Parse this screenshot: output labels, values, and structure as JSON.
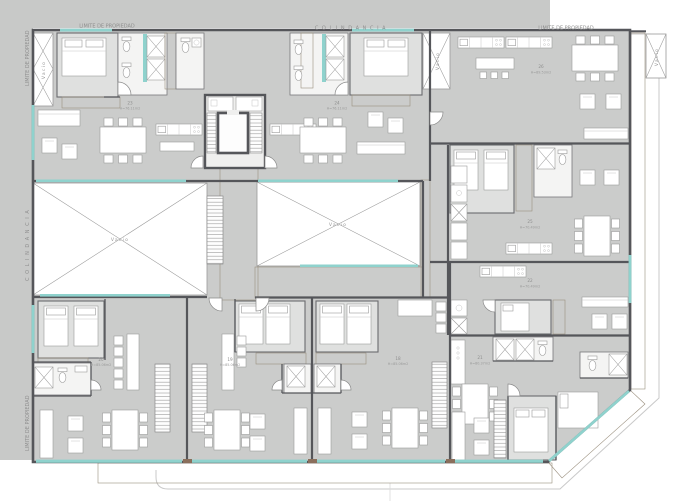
{
  "drawing": {
    "boundary": {
      "limite_top_left": "LIMITE  DE  PROPIEDAD",
      "colindancia_top": "COLINDANCIA",
      "limite_top_right": "LIMITE  DE  PROPIEDAD",
      "limite_left_upper": "LIMITE  DE  PROPIEDAD",
      "colindancia_left": "COLINDANCIA",
      "limite_left_lower": "LIMITE  DE  PROPIEDAD"
    },
    "void_label": "Vacio",
    "units": {
      "u18": {
        "no": "18",
        "area": "H=85.06m2"
      },
      "u19": {
        "no": "19",
        "area": "H=85.06m2"
      },
      "u20": {
        "no": "20",
        "area": "H=85.06m2"
      },
      "u21": {
        "no": "21",
        "area": "H=80.37m2"
      },
      "u22": {
        "no": "22",
        "area": "H=70.49m2"
      },
      "u25": {
        "no": "25",
        "area": "H=70.49m2"
      },
      "u26": {
        "no": "26",
        "area": "H=89.53m2"
      },
      "u23": {
        "no": "23",
        "area": "H=76.11m2"
      },
      "u24": {
        "no": "24",
        "area": "H=76.11m2"
      }
    },
    "colors": {
      "glazing": "#8fd2cd",
      "wood": "#b2916f",
      "wall": "#55565a",
      "floor": "#cbcccb",
      "room_light": "#dfe0df",
      "surround": "#c8c9c8"
    }
  }
}
